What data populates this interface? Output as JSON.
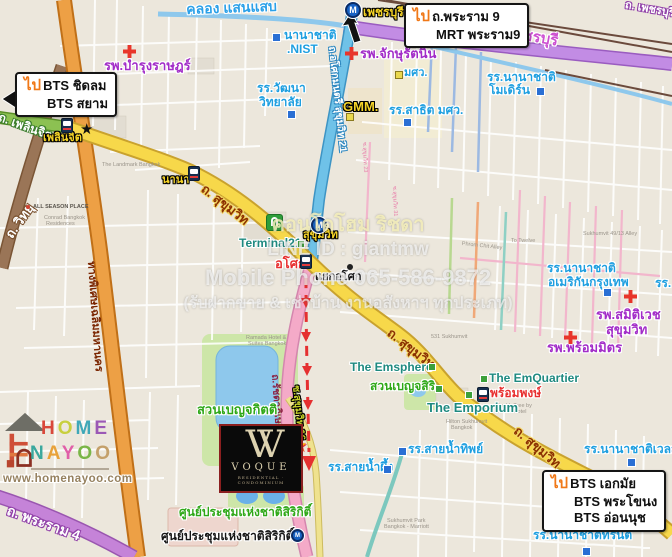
{
  "page": {
    "width": 672,
    "height": 557,
    "description": "แผนที่ทำเลคอนโด Voque Sukhumvit 16 ย่านอโศก-สุขุมวิท"
  },
  "colors": {
    "accent_orange": "#f07818",
    "road_yellow": "#f7d84a",
    "road_pink": "#f4aac8",
    "road_blue": "#6fc2e8",
    "road_purple": "#c28ce4",
    "road_orange": "#eda045",
    "expressway_label": "#7a2500",
    "water": "#8ec8ec",
    "park": "#cde6a8",
    "school_blue": "#1e9fe0",
    "hospital_purple": "#a22cc8",
    "station_red": "#e83030",
    "station_yellow": "#f5d327",
    "poi_green": "#2fa818",
    "mall_teal": "#1f8a80",
    "route_red": "#e53030",
    "vogue_gold": "#ddd2b0"
  },
  "watermark": {
    "lines": [
      "คอนโดโฮม ริชดา",
      "LINE ID : giantmw",
      "Mobile Phone 065-586-9872",
      "(รับฝากขาย & เช่าบ้าน งานอสังหาฯ ทุกประเภท)"
    ]
  },
  "branding": {
    "homenayoo": {
      "row1": [
        {
          "ch": "H",
          "c": "#d9483b"
        },
        {
          "ch": "O",
          "c": "#c8cf3e"
        },
        {
          "ch": "M",
          "c": "#3fa8b8"
        },
        {
          "ch": "E",
          "c": "#9b59b6"
        }
      ],
      "row2": [
        {
          "ch": "N",
          "c": "#3aa89e"
        },
        {
          "ch": "A",
          "c": "#e8a23a"
        },
        {
          "ch": "Y",
          "c": "#e05fa8"
        },
        {
          "ch": "O",
          "c": "#7ab648"
        },
        {
          "ch": "O",
          "c": "#c4a06a"
        }
      ],
      "url": "www.homenayoo.com"
    },
    "vogue": {
      "monogram": "VV",
      "name": "VOQUE",
      "sub": "RESIDENTIAL · CONDOMINIUM"
    }
  },
  "map": {
    "callouts": [
      {
        "n": "callout-rama9",
        "x": 404,
        "y": 3,
        "prefix": "ไป",
        "lines": [
          "ถ.พระราม 9",
          "MRT พระราม9"
        ],
        "indent": [
          false,
          true
        ]
      },
      {
        "n": "callout-chitlom",
        "x": 15,
        "y": 72,
        "prefix": "ไป",
        "lines": [
          "BTS ชิดลม",
          "BTS สยาม"
        ],
        "indent": [
          false,
          true
        ]
      },
      {
        "n": "callout-ekkamai",
        "x": 542,
        "y": 470,
        "prefix": "ไป",
        "lines": [
          "BTS เอกมัย",
          "BTS พระโขนง",
          "BTS อ่อนนุช"
        ],
        "indent": [
          false,
          true,
          true
        ]
      }
    ],
    "labels": [
      {
        "n": "canal-saensaep-label",
        "t": "คลอง แสนแสบ",
        "x": 186,
        "y": 2,
        "s": 14,
        "c": "canal",
        "r": -2
      },
      {
        "n": "mrt-phetchaburi-label",
        "t": "เพชรบุรี",
        "x": 363,
        "y": 6,
        "s": 12,
        "c": "y"
      },
      {
        "n": "phetchaburi-road-label",
        "t": "ถ. เพชรบุรี",
        "x": 492,
        "y": 22,
        "s": 15,
        "c": "phet",
        "r": 10
      },
      {
        "n": "phetchaburi-road-label-2",
        "t": "ถ. เพชรบุรี",
        "x": 626,
        "y": 0,
        "s": 11,
        "c": "roadw-purple",
        "r": 10
      },
      {
        "n": "rutnin-hospital-label",
        "t": "รพ.จักษุรัตนิน",
        "x": 360,
        "y": 47,
        "s": 13,
        "c": "p"
      },
      {
        "n": "nist-school-label-1",
        "t": "นานาชาติ",
        "x": 284,
        "y": 29,
        "s": 12,
        "c": "b"
      },
      {
        "n": "nist-school-label-2",
        "t": ".NIST",
        "x": 287,
        "y": 43,
        "s": 12,
        "c": "b"
      },
      {
        "n": "bumrungrad-hospital-label",
        "t": "รพ.บำรุงราษฎร์",
        "x": 104,
        "y": 59,
        "s": 13,
        "c": "p"
      },
      {
        "n": "wattana-school-label-1",
        "t": "รร.วัฒนา",
        "x": 257,
        "y": 82,
        "s": 12,
        "c": "b"
      },
      {
        "n": "wattana-school-label-2",
        "t": "วิทยาลัย",
        "x": 259,
        "y": 96,
        "s": 12,
        "c": "b"
      },
      {
        "n": "swu-label",
        "t": "มศว.",
        "x": 404,
        "y": 68,
        "s": 11,
        "c": "b"
      },
      {
        "n": "gmm-label",
        "t": "GMM.",
        "x": 343,
        "y": 100,
        "s": 13,
        "c": "y"
      },
      {
        "n": "satit-swu-school-label",
        "t": "รร.สาธิต มศว.",
        "x": 389,
        "y": 104,
        "s": 12,
        "c": "b"
      },
      {
        "n": "modern-school-label-1",
        "t": "รร.นานาชาติ",
        "x": 487,
        "y": 71,
        "s": 12,
        "c": "b"
      },
      {
        "n": "modern-school-label-2",
        "t": "โมเดิร์น",
        "x": 489,
        "y": 84,
        "s": 12,
        "c": "b"
      },
      {
        "n": "asok-montri-road-label",
        "t": "ถ.อโศกมนตรี สุขุมวิท 21",
        "x": 336,
        "y": 46,
        "s": 10,
        "c": "roadv-blue",
        "r": 84
      },
      {
        "n": "witthayu-road-label",
        "t": "ถ. วิทยุ",
        "x": 3,
        "y": 233,
        "s": 13,
        "c": "roadw-brown",
        "r": -55
      },
      {
        "n": "phloenchit-road-label",
        "t": "ถ. เพลินจิต",
        "x": 1,
        "y": 111,
        "s": 12,
        "c": "roadw-green",
        "r": 20
      },
      {
        "n": "phloenchit-station-label",
        "t": "เพลินจิต",
        "x": 43,
        "y": 133,
        "s": 11,
        "c": "y"
      },
      {
        "n": "nana-station-label",
        "t": "นานา",
        "x": 162,
        "y": 175,
        "s": 11,
        "c": "y"
      },
      {
        "n": "sukhumvit-road-label-1",
        "t": "ถ. สุขุมวิท",
        "x": 207,
        "y": 182,
        "s": 13,
        "c": "road",
        "r": 38
      },
      {
        "n": "terminal21-label",
        "t": "Terminal21",
        "x": 239,
        "y": 237,
        "s": 12,
        "c": "t"
      },
      {
        "n": "mrt-sukhumvit-label",
        "t": "สุขุมวิท",
        "x": 303,
        "y": 230,
        "s": 11,
        "c": "y"
      },
      {
        "n": "asok-station-label",
        "t": "อโศก",
        "x": 275,
        "y": 257,
        "s": 13,
        "c": "r"
      },
      {
        "n": "asok-junction-label",
        "t": "แยกอโศก",
        "x": 315,
        "y": 272,
        "s": 11,
        "c": "blk"
      },
      {
        "n": "expressway-label",
        "t": "ทางพิเศษเฉลิมมหานคร",
        "x": 96,
        "y": 261,
        "s": 11,
        "c": "expw",
        "r": 86
      },
      {
        "n": "ratchadaphisek-road-label",
        "t": "ถ.รัชดาภิเษก",
        "x": 279,
        "y": 374,
        "s": 10,
        "c": "ratch",
        "r": 86
      },
      {
        "n": "soi16-label",
        "t": "ซ.สุขุมวิท 16",
        "x": 300,
        "y": 385,
        "s": 10,
        "c": "soi16",
        "r": 84
      },
      {
        "n": "sukhumvit-road-label-2",
        "t": "ถ. สุขุมวิท",
        "x": 393,
        "y": 326,
        "s": 13,
        "c": "road",
        "r": 38
      },
      {
        "n": "sukhumvit-road-label-3",
        "t": "ถ. สุขุมวิท",
        "x": 520,
        "y": 424,
        "s": 13,
        "c": "road",
        "r": 40
      },
      {
        "n": "benjakitti-park-label",
        "t": "สวนเบญจกิตติ",
        "x": 197,
        "y": 403,
        "s": 13,
        "c": "g"
      },
      {
        "n": "benjasiri-park-label",
        "t": "สวนเบญจสิริ",
        "x": 370,
        "y": 380,
        "s": 12,
        "c": "g"
      },
      {
        "n": "emquartier-label",
        "t": "The EmQuartier",
        "x": 489,
        "y": 372,
        "s": 12,
        "c": "t"
      },
      {
        "n": "phromphong-station-label",
        "t": "พร้อมพงษ์",
        "x": 490,
        "y": 387,
        "s": 12,
        "c": "r"
      },
      {
        "n": "emporium-label",
        "t": "The Emporium",
        "x": 427,
        "y": 401,
        "s": 13,
        "c": "t"
      },
      {
        "n": "emsphere-label",
        "t": "The Emsphere",
        "x": 350,
        "y": 361,
        "s": 12,
        "c": "t"
      },
      {
        "n": "sainamthip-school-label",
        "t": "รร.สายน้ำทิพย์",
        "x": 408,
        "y": 443,
        "s": 12,
        "c": "b"
      },
      {
        "n": "sainamphueng-school-label",
        "t": "รร.สายน้ำผึ้ง",
        "x": 328,
        "y": 461,
        "s": 12,
        "c": "b"
      },
      {
        "n": "wells-school-label",
        "t": "รร.นานาชาติเวลส์",
        "x": 584,
        "y": 443,
        "s": 12,
        "c": "b"
      },
      {
        "n": "trinity-school-label",
        "t": "รร.นานาชาติทรินิตี้",
        "x": 533,
        "y": 529,
        "s": 12,
        "c": "b"
      },
      {
        "n": "edge-school-label",
        "t": "รร.",
        "x": 655,
        "y": 277,
        "s": 12,
        "c": "b"
      },
      {
        "n": "american-school-label-1",
        "t": "รร.นานาชาติ",
        "x": 547,
        "y": 262,
        "s": 12,
        "c": "b"
      },
      {
        "n": "american-school-label-2",
        "t": "อเมริกันกรุงเทพ",
        "x": 548,
        "y": 276,
        "s": 12,
        "c": "b"
      },
      {
        "n": "samitivej-hospital-label-1",
        "t": "รพ.สมิติเวช",
        "x": 596,
        "y": 308,
        "s": 13,
        "c": "p"
      },
      {
        "n": "samitivej-hospital-label-2",
        "t": "สุขุมวิท",
        "x": 606,
        "y": 323,
        "s": 13,
        "c": "p"
      },
      {
        "n": "phrommit-hospital-label",
        "t": "รพ.พร้อมมิตร",
        "x": 547,
        "y": 341,
        "s": 13,
        "c": "p"
      },
      {
        "n": "qsncc-label",
        "t": "ศูนย์ประชุมแห่งชาติสิริกิติ์",
        "x": 179,
        "y": 506,
        "s": 12,
        "c": "g"
      },
      {
        "n": "qsncc-station-label",
        "t": "ศูนย์ประชุมแห่งชาติสิริกิติ์",
        "x": 161,
        "y": 530,
        "s": 12,
        "c": "blk"
      },
      {
        "n": "rama4-road-label",
        "t": "ถ. พระราม 4",
        "x": 10,
        "y": 503,
        "s": 14,
        "c": "roadw-purple",
        "r": 20
      }
    ],
    "minor_labels": [
      {
        "t": "ALL SEASON PLACE",
        "x": 33,
        "y": 205,
        "c": "md"
      },
      {
        "t": "Conrad Bangkok",
        "x": 44,
        "y": 216,
        "c": "m"
      },
      {
        "t": "Residences",
        "x": 46,
        "y": 222,
        "c": "m"
      },
      {
        "t": "The Landmark Bangkok",
        "x": 102,
        "y": 163,
        "c": "m"
      },
      {
        "t": "Ramada Hotel &",
        "x": 246,
        "y": 336,
        "c": "m"
      },
      {
        "t": "Suites Bangkok",
        "x": 248,
        "y": 342,
        "c": "m"
      },
      {
        "t": "531 Sukhumvit",
        "x": 431,
        "y": 335,
        "c": "m"
      },
      {
        "t": "Hilton Sukhumvit",
        "x": 446,
        "y": 420,
        "c": "m"
      },
      {
        "t": "Bangkok",
        "x": 451,
        "y": 426,
        "c": "m"
      },
      {
        "t": "DoubleTree by",
        "x": 496,
        "y": 404,
        "c": "m"
      },
      {
        "t": "Hilton Hotel",
        "x": 498,
        "y": 410,
        "c": "m"
      },
      {
        "t": "Sukhumvit Park",
        "x": 387,
        "y": 519,
        "c": "m"
      },
      {
        "t": "Bangkok - Marriott",
        "x": 384,
        "y": 525,
        "c": "m"
      },
      {
        "t": "Sukhumvit 49/13 Alley",
        "x": 583,
        "y": 232,
        "c": "m"
      },
      {
        "t": "Phrom Chit Alley",
        "x": 462,
        "y": 242,
        "c": "m",
        "r": 6
      },
      {
        "t": "To Twelve",
        "x": 511,
        "y": 239,
        "c": "m"
      },
      {
        "t": "ซ.สุขุมวิท 23",
        "x": 366,
        "y": 142,
        "c": "mp",
        "r": 88
      },
      {
        "t": "ซ.สุขุมวิท 31",
        "x": 396,
        "y": 186,
        "c": "mp",
        "r": 88
      }
    ],
    "markers": [
      {
        "n": "mrt-phetchaburi-icon",
        "type": "mrt",
        "x": 345,
        "y": 2,
        "s": 16
      },
      {
        "n": "mrt-sukhumvit-icon",
        "type": "mrt",
        "x": 311,
        "y": 217,
        "s": 16
      },
      {
        "n": "mrt-qsncc-icon",
        "type": "mrt",
        "x": 291,
        "y": 529,
        "s": 13
      },
      {
        "n": "bts-phloenchit-icon",
        "type": "bts",
        "x": 61,
        "y": 118
      },
      {
        "n": "bts-nana-icon",
        "type": "bts",
        "x": 188,
        "y": 166
      },
      {
        "n": "bts-asok-icon",
        "type": "bts",
        "x": 300,
        "y": 254
      },
      {
        "n": "bts-phromphong-icon",
        "type": "bts",
        "x": 477,
        "y": 387
      },
      {
        "n": "terminal21-icon",
        "type": "t21",
        "x": 266,
        "y": 214
      },
      {
        "n": "bumrungrad-cross-icon",
        "type": "cross",
        "x": 123,
        "y": 45
      },
      {
        "n": "rutnin-cross-icon",
        "type": "cross",
        "x": 345,
        "y": 47
      },
      {
        "n": "samitivej-cross-icon",
        "type": "cross",
        "x": 624,
        "y": 290
      },
      {
        "n": "phrommit-cross-icon",
        "type": "cross",
        "x": 564,
        "y": 331
      },
      {
        "n": "nist-square-marker",
        "type": "sqb",
        "x": 272,
        "y": 33
      },
      {
        "n": "wattana-square-marker",
        "type": "sqb",
        "x": 287,
        "y": 110
      },
      {
        "n": "satit-square-marker",
        "type": "sqb",
        "x": 403,
        "y": 118
      },
      {
        "n": "modern-square-marker",
        "type": "sqb",
        "x": 536,
        "y": 87
      },
      {
        "n": "american-square-marker",
        "type": "sqb",
        "x": 603,
        "y": 288
      },
      {
        "n": "sainamthip-square-marker",
        "type": "sqb",
        "x": 398,
        "y": 447
      },
      {
        "n": "sainamphueng-square-marker",
        "type": "sqb",
        "x": 383,
        "y": 465
      },
      {
        "n": "wells-square-marker",
        "type": "sqb",
        "x": 627,
        "y": 458
      },
      {
        "n": "trinity-square-marker",
        "type": "sqb",
        "x": 582,
        "y": 547
      },
      {
        "n": "terminal21-square-marker",
        "type": "sqg",
        "x": 297,
        "y": 240
      },
      {
        "n": "emsphere-square-marker",
        "type": "sqg",
        "x": 428,
        "y": 363
      },
      {
        "n": "emquartier-square-marker",
        "type": "sqg",
        "x": 480,
        "y": 375
      },
      {
        "n": "benjasiri-square-marker",
        "type": "sqg",
        "x": 435,
        "y": 385
      },
      {
        "n": "emporium-square-marker",
        "type": "sqg",
        "x": 465,
        "y": 391
      },
      {
        "n": "swu-square-marker",
        "type": "sqy",
        "x": 395,
        "y": 71
      },
      {
        "n": "gmm-square-marker",
        "type": "sqy",
        "x": 346,
        "y": 113
      },
      {
        "n": "phloenchit-junction-star-icon",
        "type": "star-b",
        "x": 80,
        "y": 122
      },
      {
        "n": "project-location-star-icon",
        "type": "star-o",
        "x": 292,
        "y": 437
      },
      {
        "n": "asok-junction-dot",
        "type": "dot",
        "x": 347,
        "y": 264
      },
      {
        "n": "allseason-poi-dot",
        "type": "dot-r",
        "x": 26,
        "y": 205
      }
    ]
  }
}
